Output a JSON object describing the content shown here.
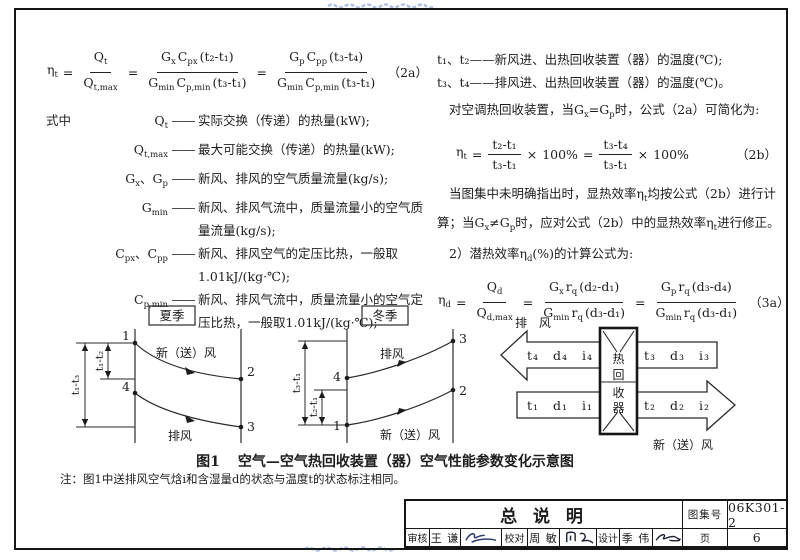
{
  "page": {
    "ink": "#1d1d1d",
    "watermark_blue": "#6f8fd0",
    "dash": "——"
  },
  "left_column": {
    "where_label": "式中",
    "formula_2a": {
      "tokens": [
        {
          "v": "η",
          "s": "t"
        },
        {
          "o": "="
        },
        {
          "f": {
            "n": [
              {
                "v": "Q",
                "s": "t"
              }
            ],
            "d": [
              {
                "v": "Q",
                "s": "t,max"
              }
            ]
          }
        },
        {
          "o": "="
        },
        {
          "f": {
            "n": [
              {
                "v": "G",
                "s": "x"
              },
              {
                "v": "C",
                "s": "px"
              },
              {
                "v": "(t₂-t₁)"
              }
            ],
            "d": [
              {
                "v": "G",
                "s": "min"
              },
              {
                "v": "C",
                "s": "p,min"
              },
              {
                "v": "(t₃-t₁)"
              }
            ]
          }
        },
        {
          "o": "="
        },
        {
          "f": {
            "n": [
              {
                "v": "G",
                "s": "p"
              },
              {
                "v": "C",
                "s": "pp"
              },
              {
                "v": "(t₃-t₄)"
              }
            ],
            "d": [
              {
                "v": "G",
                "s": "min"
              },
              {
                "v": "C",
                "s": "p,min"
              },
              {
                "v": "(t₃-t₁)"
              }
            ]
          }
        }
      ],
      "tag": "（2a）"
    },
    "definitions": [
      {
        "term": "Q~t~",
        "def": "实际交换（传递）的热量(kW);"
      },
      {
        "term": "Q~t,max~",
        "def": "最大可能交换（传递）的热量(kW);"
      },
      {
        "term": "G~x~、G~p~",
        "def": "新风、排风的空气质量流量(kg/s);"
      },
      {
        "term": "G~min~",
        "def": "新风、排风气流中，质量流量小的空气质量流量(kg/s);"
      },
      {
        "term": "C~px~、C~pp~",
        "def": "新风、排风空气的定压比热，一般取1.01kJ/(kg·℃);"
      },
      {
        "term": "C~p,min~",
        "def": "新风、排风气流中，质量流量小的空气定压比热，一般取1.01kJ/(kg·℃);"
      }
    ]
  },
  "right_column": {
    "line_t12": "t₁、t₂——新风进、出热回收装置（器）的温度(℃);",
    "line_t34": "t₃、t₄——排风进、出热回收装置（器）的温度(℃)。",
    "line_simplify": "对空调热回收装置，当G~x~=G~p~时，公式（2a）可简化为:",
    "formula_2b": {
      "tokens": [
        {
          "v": "η",
          "s": "t"
        },
        {
          "o": "="
        },
        {
          "f": {
            "n": [
              {
                "v": "t₂-t₁"
              }
            ],
            "d": [
              {
                "v": "t₃-t₁"
              }
            ]
          }
        },
        {
          "o": "×"
        },
        {
          "v": "100%"
        },
        {
          "o": "="
        },
        {
          "f": {
            "n": [
              {
                "v": "t₃-t₄"
              }
            ],
            "d": [
              {
                "v": "t₃-t₁"
              }
            ]
          }
        },
        {
          "o": "×"
        },
        {
          "v": "100%"
        }
      ],
      "tag": "（2b）"
    },
    "line_note1": "当图集中未明确指出时，显热效率η~t~均按公式（2b）进行计",
    "line_note2": "算；当G~x~≠G~p~时，应对公式（2b）中的显热效率η~t~进行修正。",
    "line_latent": "2）潜热效率η~d~(%)的计算公式为:",
    "formula_3a": {
      "tokens": [
        {
          "v": "η",
          "s": "d"
        },
        {
          "o": "="
        },
        {
          "f": {
            "n": [
              {
                "v": "Q",
                "s": "d"
              }
            ],
            "d": [
              {
                "v": "Q",
                "s": "d,max"
              }
            ]
          }
        },
        {
          "o": "="
        },
        {
          "f": {
            "n": [
              {
                "v": "G",
                "s": "x"
              },
              {
                "v": "r",
                "s": "q"
              },
              {
                "v": "(d₂-d₁)"
              }
            ],
            "d": [
              {
                "v": "G",
                "s": "min"
              },
              {
                "v": "r",
                "s": "q"
              },
              {
                "v": "(d₃-d₁)"
              }
            ]
          }
        },
        {
          "o": "="
        },
        {
          "f": {
            "n": [
              {
                "v": "G",
                "s": "p"
              },
              {
                "v": "r",
                "s": "q"
              },
              {
                "v": "(d₃-d₄)"
              }
            ],
            "d": [
              {
                "v": "G",
                "s": "min"
              },
              {
                "v": "r",
                "s": "q"
              },
              {
                "v": "(d₃-d₁)"
              }
            ]
          }
        }
      ],
      "tag": "（3a）"
    }
  },
  "figure": {
    "summer": {
      "season": "夏季",
      "supply_label": "新（送）风",
      "exhaust_label": "排风",
      "dim_inner": "t₁-t₂",
      "dim_outer": "t₁-t₃",
      "points": {
        "p1": "1",
        "p2": "2",
        "p3": "3",
        "p4": "4"
      }
    },
    "winter": {
      "season": "冬季",
      "supply_label": "新（送）风",
      "exhaust_label": "排风",
      "dim_outer": "t₃-t₁",
      "dim_inner": "t₂-t₁",
      "points": {
        "p1": "1",
        "p2": "2",
        "p3": "3",
        "p4": "4"
      }
    },
    "exchanger": {
      "exhaust_label": "排 风",
      "supply_label": "新（送）风",
      "box_chars": [
        "热",
        "回",
        "收",
        "器"
      ],
      "top_left": "t₄ d₄ i₄",
      "top_right": "t₃ d₃ i₃",
      "bottom_left": "t₁ d₁ i₁",
      "bottom_right": "t₂ d₂ i₂"
    },
    "caption_no": "图1",
    "caption": "空气—空气热回收装置（器）空气性能参数变化示意图",
    "note": "注：图1中送排风空气焓i和含湿量d的状态与温度t的状态标注相同。"
  },
  "title_block": {
    "title": "总 说 明",
    "atlas_label": "图集号",
    "atlas_no": "06K301-2",
    "page_label": "页",
    "page_no": "6",
    "review_label": "审核",
    "reviewer": "王 谦",
    "check_label": "校对",
    "checker": "周 敏",
    "design_label": "设计",
    "designer": "季 伟"
  }
}
